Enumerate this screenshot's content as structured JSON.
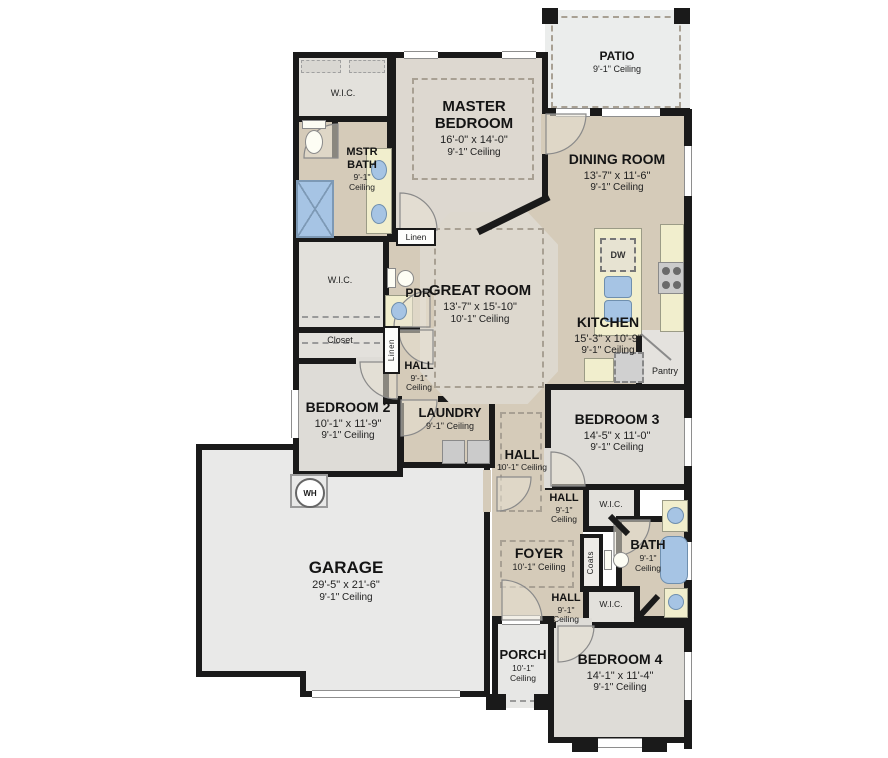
{
  "rooms": {
    "patio": {
      "name": "PATIO",
      "ceiling": "9'-1\" Ceiling"
    },
    "master_bedroom": {
      "name": "MASTER BEDROOM",
      "dims": "16'-0\" x 14'-0\"",
      "ceiling": "9'-1\" Ceiling"
    },
    "dining_room": {
      "name": "DINING ROOM",
      "dims": "13'-7\" x 11'-6\"",
      "ceiling": "9'-1\" Ceiling"
    },
    "master_bath": {
      "name": "MSTR BATH",
      "ceiling": "9'-1\" Ceiling"
    },
    "great_room": {
      "name": "GREAT ROOM",
      "dims": "13'-7\" x 15'-10\"",
      "ceiling": "10'-1\" Ceiling"
    },
    "kitchen": {
      "name": "KITCHEN",
      "dims": "15'-3\" x 10'-9\"",
      "ceiling": "9'-1\" Ceiling"
    },
    "powder": {
      "name": "PDR"
    },
    "hall_bed2": {
      "name": "HALL",
      "ceiling": "9'-1\" Ceiling"
    },
    "bedroom2": {
      "name": "BEDROOM 2",
      "dims": "10'-1\" x 11'-9\"",
      "ceiling": "9'-1\" Ceiling"
    },
    "laundry": {
      "name": "LAUNDRY",
      "ceiling": "9'-1\" Ceiling"
    },
    "hall_main": {
      "name": "HALL",
      "ceiling": "10'-1\" Ceiling"
    },
    "bedroom3": {
      "name": "BEDROOM 3",
      "dims": "14'-5\" x 11'-0\"",
      "ceiling": "9'-1\" Ceiling"
    },
    "hall_bed3": {
      "name": "HALL",
      "ceiling": "9'-1\" Ceiling"
    },
    "foyer": {
      "name": "FOYER",
      "ceiling": "10'-1\" Ceiling"
    },
    "bath2": {
      "name": "BATH",
      "ceiling": "9'-1\" Ceiling"
    },
    "hall_bed4": {
      "name": "HALL",
      "ceiling": "9'-1\" Ceiling"
    },
    "garage": {
      "name": "GARAGE",
      "dims": "29'-5\" x 21'-6\"",
      "ceiling": "9'-1\" Ceiling"
    },
    "porch": {
      "name": "PORCH",
      "ceiling": "10'-1\" Ceiling"
    },
    "bedroom4": {
      "name": "BEDROOM 4",
      "dims": "14'-1\" x 11'-4\"",
      "ceiling": "9'-1\" Ceiling"
    }
  },
  "storage": {
    "wic": "W.I.C.",
    "closet": "Closet",
    "linen": "Linen",
    "pantry": "Pantry",
    "coats": "Coats"
  },
  "fixtures": {
    "dishwasher": "DW",
    "water_heater": "WH"
  },
  "colors": {
    "wall": "#1a1a1a",
    "floor_tan": "#d5cbb9",
    "floor_master": "#ddd8d0",
    "floor_great": "#ddd8ce",
    "floor_bedroom": "#dedcd7",
    "floor_closet": "#e3e1dc",
    "floor_garage": "#e9e9e8",
    "floor_patio": "#ebedec",
    "counter_yellow": "#f1eecd",
    "fixture_blue": "#a6c4e4"
  }
}
